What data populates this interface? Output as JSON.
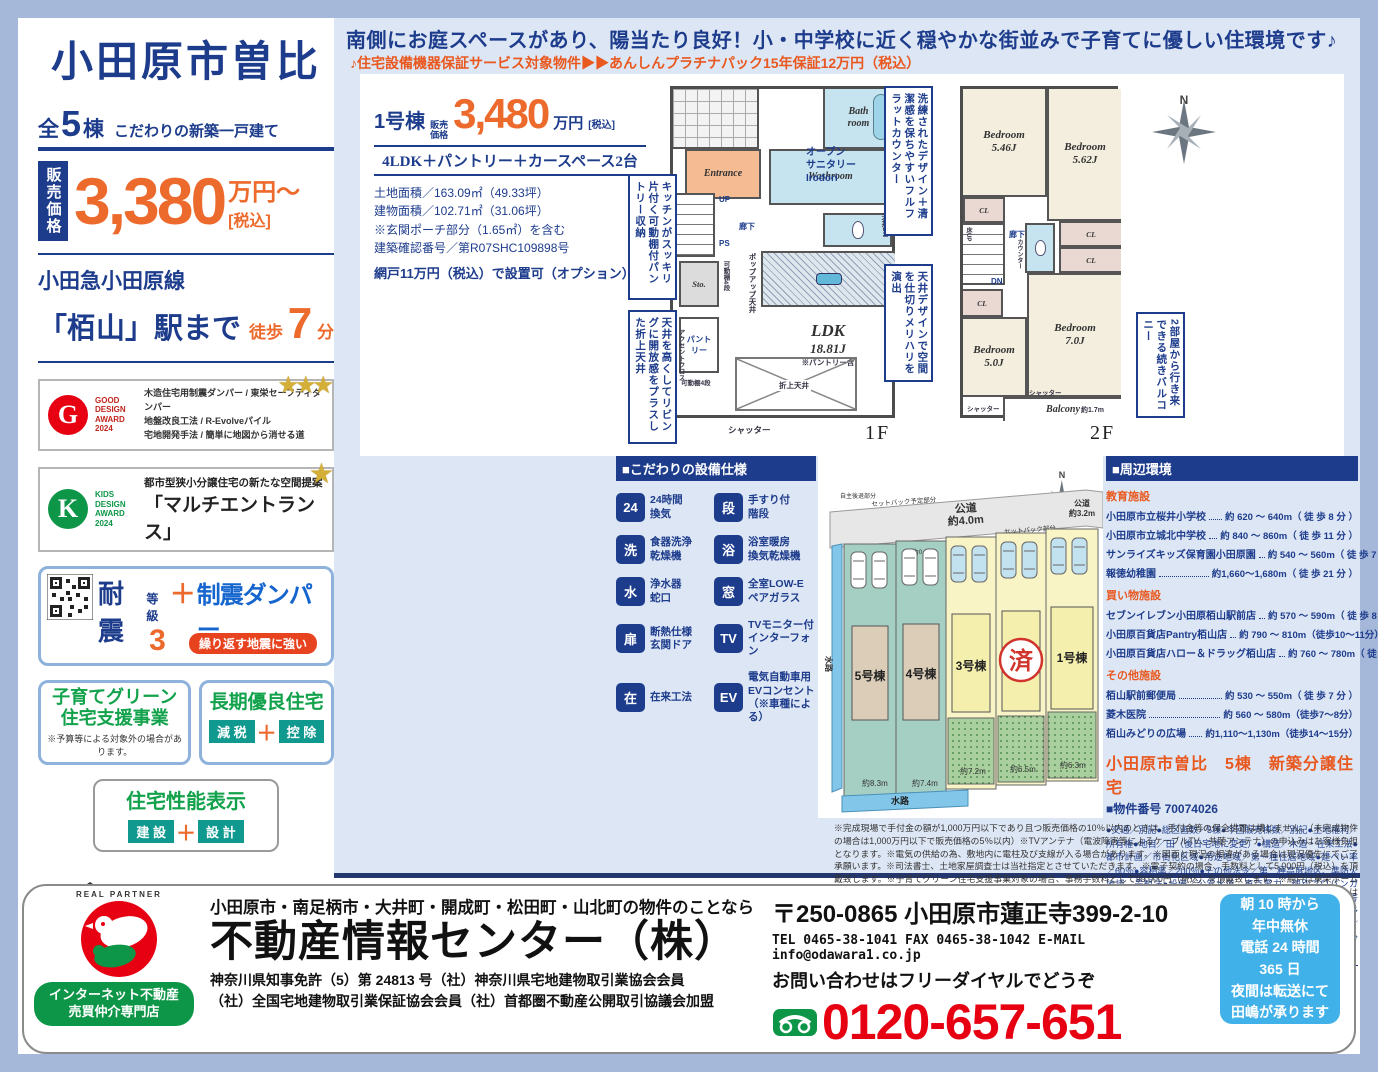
{
  "page": {
    "catch_copy": "南側にお庭スペースがあり、陽当たり良好！小・中学校に近く穏やかな街並みで子育てに優しい住環境です♪",
    "service_line": "♪住宅設備機器保証サービス対象物件▶▶あんしんプラチナパック15年保証12万円（税込）"
  },
  "sidebar": {
    "title": "小田原市曽比",
    "units_prefix": "全",
    "units_num": "5",
    "units_suffix": "棟",
    "units_tagline": "こだわりの新築一戸建て",
    "price_label": "販売価格",
    "price_value": "3,380",
    "price_unit": "万円～",
    "price_tax": "[税込]",
    "rail_line": "小田急小田原線",
    "station": "「栢山」駅まで",
    "walk_prefix": "徒歩",
    "walk_num": "7",
    "walk_suffix": "分",
    "good_design": {
      "logo": "G",
      "award": "GOOD\nDESIGN\nAWARD\n2024",
      "line1": "木造住宅用制震ダンパー / 東栄セーフティダンパー",
      "line2": "地盤改良工法 / R-Evolveパイル",
      "line3": "宅地開発手法 / 簡単に地図から消せる道",
      "stars": "★★★"
    },
    "kids_design": {
      "logo": "K",
      "award": "KIDS\nDESIGN\nAWARD\n2024",
      "line1": "都市型狭小分譲住宅の新たな空間提案",
      "line2": "「マルチエントランス」",
      "star": "★"
    },
    "taishin": {
      "word1": "耐震",
      "word2": "等級",
      "grade": "3",
      "plus": "＋",
      "word3": "制震ダンパー",
      "badge": "繰り返す地震に強い"
    },
    "kosodate": {
      "line1": "子育てグリーン",
      "line2": "住宅支援事業",
      "note": "※予算等による対象外の場合があります。"
    },
    "choki": {
      "title": "長期優良住宅",
      "tag1": "減 税",
      "plus": "＋",
      "tag2": "控 除"
    },
    "seino": {
      "title": "住宅性能表示",
      "tag1": "建 設",
      "plus": "＋",
      "tag2": "設 計"
    },
    "image_caption": "イメージパース※このイラストは図面を基に描き起こしたもので実際とは多少異なります。"
  },
  "unit1": {
    "name": "1号棟",
    "price_label": "販売\n価格",
    "price_value": "3,480",
    "price_unit": "万円",
    "price_tax": "[税込]",
    "layout": "4LDK＋パントリー＋カースペース2台",
    "spec1": "土地面積／163.09㎡（49.33坪）",
    "spec2": "建物面積／102.71㎡（31.06坪）",
    "spec3": "※玄関ポーチ部分（1.65㎡）を含む",
    "spec4": "建築確認番号／第R07SHC109898号",
    "option": "網戸11万円（税込）で設置可（オプション）"
  },
  "floor1": {
    "entrance": "Entrance",
    "bath": "Bath\nroom",
    "washroom": "Washroom",
    "hall": "廊下",
    "up": "UP",
    "ps": "PS",
    "sto": "Sto.",
    "pantry": "パント\nリー",
    "ldk": "LDK",
    "ldk_size": "18.81J",
    "ldk_note": "※パントリー含",
    "popup": "ポップアップ天井",
    "oriage": "折上天井",
    "shutter": "シャッター",
    "ceiling_dn": "天井DN",
    "accent": "アクセントクロス",
    "shelf": "可動棚4段",
    "label": "1F"
  },
  "floor2": {
    "bed1": "Bedroom",
    "bed1_size": "5.46J",
    "bed2": "Bedroom",
    "bed2_size": "5.62J",
    "bed3": "Bedroom",
    "bed3_size": "7.0J",
    "bed4": "Bedroom",
    "bed4_size": "5.0J",
    "cl": "CL",
    "hall": "廊下",
    "dn": "DN",
    "counter": "カウンター",
    "floor_up": "床UP",
    "balcony": "Balcony",
    "shutter": "シャッター",
    "depth": "約1.7m",
    "label": "2F",
    "north": "N"
  },
  "callouts": {
    "counter": "洗練されたデザイン＋清潔感を保ちやすいフルフラットカウンター",
    "sanitary": "オープン\nサニタリー\nIrodori",
    "pantry": "キッチンがスッキリ片付く可動棚付パントリー収納",
    "ceiling": "天井を高くしてリビングに開放感をプラスした折上天井",
    "partition": "天井デザインで空間を仕切りメリハリを演出",
    "balcony": "2部屋から行き来できる続きバルコニー"
  },
  "equipment": {
    "header": "■こだわりの設備仕様",
    "items": [
      {
        "icon": "24",
        "label": "24時間\n換気"
      },
      {
        "icon": "洗",
        "label": "食器洗浄\n乾燥機"
      },
      {
        "icon": "水",
        "label": "浄水器\n蛇口"
      },
      {
        "icon": "扉",
        "label": "断熱仕様\n玄関ドア"
      },
      {
        "icon": "在",
        "label": "在来工法"
      },
      {
        "icon": "段",
        "label": "手すり付\n階段"
      },
      {
        "icon": "浴",
        "label": "浴室暖房\n換気乾燥機"
      },
      {
        "icon": "窓",
        "label": "全室LOW-E\nペアガラス"
      },
      {
        "icon": "TV",
        "label": "TVモニター付\nインターフォン"
      },
      {
        "icon": "EV",
        "label": "電気自動車用\nEVコンセント\n（※車種による）"
      }
    ]
  },
  "siteplan": {
    "north": "N",
    "road_top1": "公道",
    "road_top2": "約4.0m",
    "road_right1": "公道",
    "road_right2": "約3.2m",
    "setback_plan": "セットバック予定部分",
    "setback": "セットバック部分",
    "jishu1": "自主後退部分",
    "jishu2": "自主後退部分",
    "gap": "↕約0.8m",
    "water_left": "水路",
    "water_bottom": "水路",
    "sold": "済",
    "lots": [
      {
        "name": "5号棟",
        "width": "約8.3m"
      },
      {
        "name": "4号棟",
        "width": "約7.4m"
      },
      {
        "name": "3号棟",
        "width": "約7.2m"
      },
      {
        "name": "済",
        "width": "約6.5m"
      },
      {
        "name": "1号棟",
        "width": "約6.3m"
      }
    ]
  },
  "environment": {
    "header": "■周辺環境",
    "groups": [
      {
        "title": "教育施設",
        "items": [
          {
            "name": "小田原市立桜井小学校",
            "value": "約 620 ～ 640m（ 徒 歩 8 分 ）"
          },
          {
            "name": "小田原市立城北中学校",
            "value": "約 840 ～ 860m（ 徒 歩 11 分 ）"
          },
          {
            "name": "サンライズキッズ保育園小田原園",
            "value": "約 540 ～ 560m（ 徒 歩 7 分 ）"
          },
          {
            "name": "報徳幼稚園",
            "value": "約1,660～1,680m（ 徒 歩 21 分 ）"
          }
        ]
      },
      {
        "title": "買い物施設",
        "items": [
          {
            "name": "セブンイレブン小田原栢山駅前店",
            "value": "約 570 ～ 590m（ 徒 歩 8 分 ）"
          },
          {
            "name": "小田原百貨店Pantry栢山店",
            "value": "約 790 ～ 810m（徒歩10～11分）"
          },
          {
            "name": "小田原百貨店ハロー＆ドラッグ栢山店",
            "value": "約 760 ～ 780m（ 徒 歩 10 分 ）"
          }
        ]
      },
      {
        "title": "その他施設",
        "items": [
          {
            "name": "栢山駅前郵便局",
            "value": "約 530 ～ 550m（ 徒 歩 7 分 ）"
          },
          {
            "name": "菱木医院",
            "value": "約 560 ～ 580m（徒歩7～8分）"
          },
          {
            "name": "栢山みどりの広場",
            "value": "約1,110～1,130m（徒歩14～15分）"
          }
        ]
      }
    ],
    "property_title": "小田原市曽比　5棟　新築分譲住宅",
    "property_no": "■物件番号 70074026",
    "details": "●交通／別記●総区画数／5棟●今回販売棟数／別記●土地権利／所有権●地目／田（後日宅地に変更）●構造／木造・在来工法●都市計画／市街化区域●用途地域／第一種住居地域●建ぺい率／60％●容積率／200％●その他法令／第二種高度地区、準防火地域、景観法●設備／公営水道、東京電力、個別プロパンガス、本下水●接道状況／北約3.2m～4.0m公道●完成／1～3号棟：2025年10月上旬、4・5号棟：2026年2月下旬予定●引渡予定／原則、契約後または建物完成後25日以内●セットバック／済●その他／4号棟井戸跡あり（埋戻済）、各号棟自主後退部分あり"
  },
  "disclaimer": "※完成現場で手付金の額が1,000万円以下であり且つ販売価格の10％以内のときは、手付金等の保全措置は講じません。（未完成物件の場合は1,000万円以下で販売価格の5％以内）※TVアンテナ（電波障害等によるケーブルTV、共聴アンテナ）の申込みはお客様負担となります。※電気の供給の為、敷地内に電柱及び支線が入る場合があります。※図面と現況の相違がある場合は現況優先にてご了承願います。※司法書士、土地家屋調査士は当社指定とさせていただきます。※電子契約の場合、手数料として5,000円（税込）を頂戴致します。※子育てグリーン住宅支援事業対象の場合、事務手数料として99,000円（税込）を頂戴致します。※網戸は東栄ホームサービスへの発注となります。尚表示価格は建物引渡20日前迄の申込が条件となります。※FIX窓・ドア（玄関・勝手口・テラス）は対象外となります。",
  "footer": {
    "partner": "REAL PARTNER",
    "badge": "インターネット不動産\n売買仲介専門店",
    "areas": "小田原市・南足柄市・大井町・開成町・松田町・山北町の物件のことなら",
    "company": "不動産情報センター（株）",
    "license1": "神奈川県知事免許（5）第 24813 号（社）神奈川県宅地建物取引業協会会員",
    "license2": "（社）全国宅地建物取引業保証協会会員（社）首都圏不動産公開取引協議会加盟",
    "address": "〒250-0865 小田原市蓮正寺399-2-10",
    "contact": "TEL 0465-38-1041 FAX 0465-38-1042 E-MAIL info@odawara1.co.jp",
    "inquiry": "お問い合わせはフリーダイヤルでどうぞ",
    "phone": "0120-657-651",
    "hours": "朝 10 時から\n年中無休\n電話 24 時間\n365 日\n夜間は転送にて\n田嶋が承ります"
  }
}
